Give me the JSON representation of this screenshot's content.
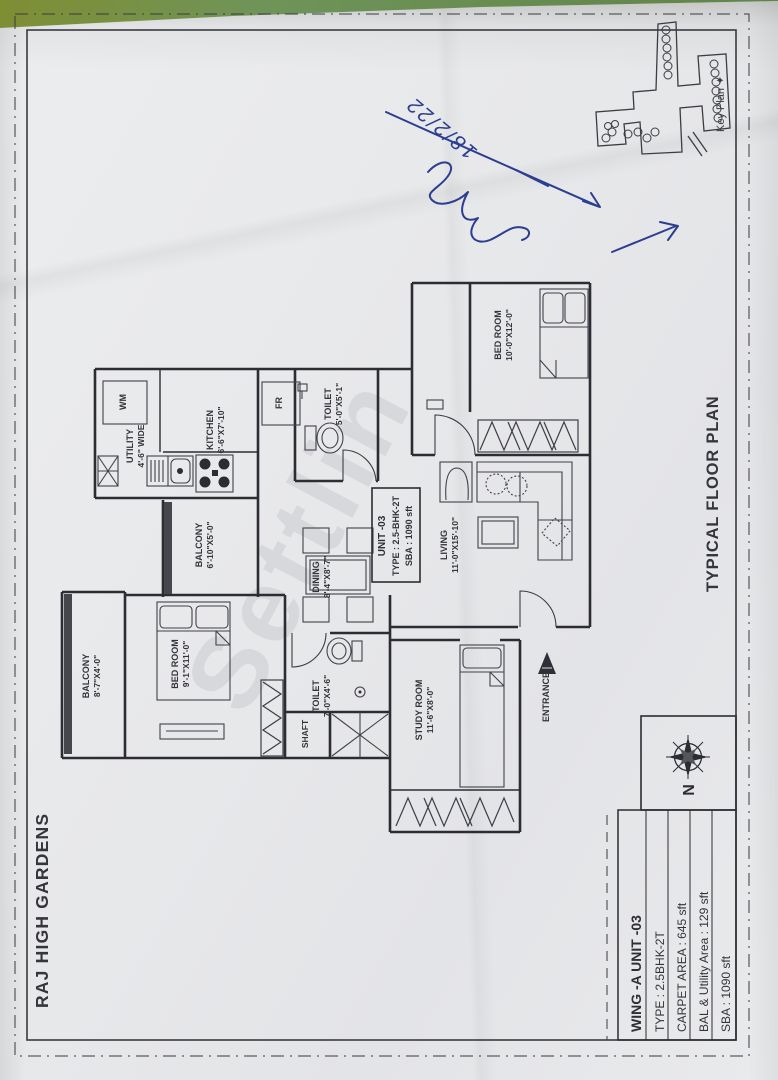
{
  "sheet": {
    "project_title": "RAJ HIGH GARDENS",
    "plan_title": "TYPICAL FLOOR PLAN",
    "key_plan_label": "Key Plan ✦",
    "north_label": "N",
    "watermark": "Settlin",
    "handwritten_date": "18/2/22",
    "colors": {
      "paper": "#e9eaec",
      "table_green": "#6f9459",
      "ink_blue": "#2c3e8f",
      "line": "#2e2e34"
    }
  },
  "unit_box": {
    "line1": "UNIT -03",
    "line2": "TYPE : 2.5-BHK-2T",
    "line3": "SBA : 1090 sft"
  },
  "info_table": {
    "title": "WING -A  UNIT -03",
    "rows": [
      "TYPE : 2.5BHK-2T",
      "CARPET AREA : 645 sft",
      "BAL & Utility Area : 129 sft",
      "SBA : 1090 sft"
    ]
  },
  "rooms": {
    "bedroom1": {
      "name": "BED ROOM",
      "dim": "10'-0\"X12'-0\""
    },
    "living": {
      "name": "LIVING",
      "dim": "11'-0\"X15'-10\""
    },
    "kitchen": {
      "name": "KITCHEN",
      "dim": "6'-6\"X7'-10\""
    },
    "utility": {
      "name": "UTILITY",
      "dim": "4'-6\" WIDE"
    },
    "toilet1": {
      "name": "TOILET",
      "dim": "5'-0\"X5'-1\""
    },
    "balcony_mid": {
      "name": "BALCONY",
      "dim": "6'-10\"X5'-0\""
    },
    "dining": {
      "name": "DINING",
      "dim": "8'-4\"X8'-7\""
    },
    "bedroom2": {
      "name": "BED ROOM",
      "dim": "9'-1\"X11'-0\""
    },
    "balcony_left": {
      "name": "BALCONY",
      "dim": "8'-7\"X4'-0\""
    },
    "toilet2": {
      "name": "TOILET",
      "dim": "7'-0\"X4'-6\""
    },
    "shaft": {
      "name": "SHAFT"
    },
    "study": {
      "name": "STUDY ROOM",
      "dim": "11'-6\"X8'-0\""
    },
    "wm": {
      "name": "WM"
    },
    "fr": {
      "name": "FR"
    },
    "entrance": {
      "name": "ENTRANCE"
    }
  }
}
